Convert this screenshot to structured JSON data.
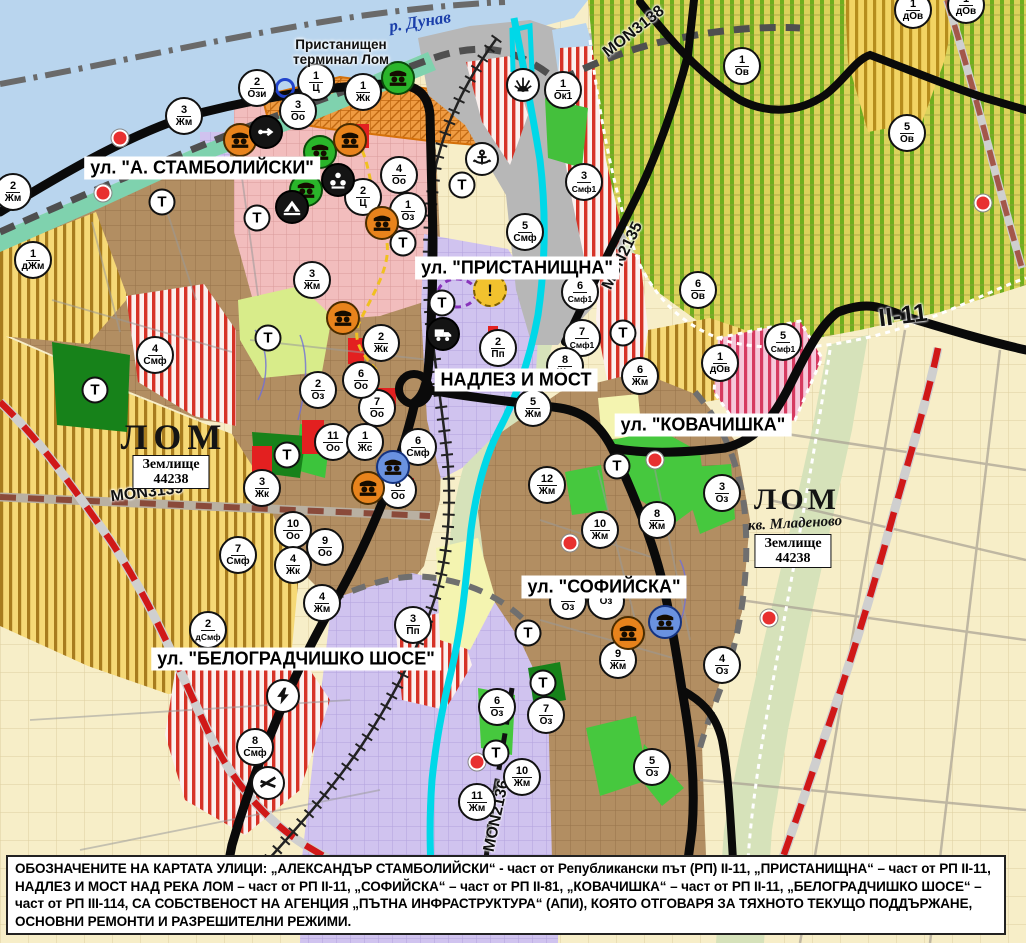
{
  "map": {
    "street_labels": [
      {
        "text": "ул. \"А. СТАМБОЛИЙСКИ\"",
        "x": 202,
        "y": 168
      },
      {
        "text": "ул. \"ПРИСТАНИЩНА\"",
        "x": 517,
        "y": 268
      },
      {
        "text": "НАДЛЕЗ И МОСТ",
        "x": 516,
        "y": 380
      },
      {
        "text": "ул. \"КОВАЧИШКА\"",
        "x": 703,
        "y": 425
      },
      {
        "text": "ул. \"СОФИЙСКА\"",
        "x": 604,
        "y": 587
      },
      {
        "text": "ул. \"БЕЛОГРАДЧИШКО ШОСЕ\"",
        "x": 296,
        "y": 659
      }
    ],
    "place_labels": [
      {
        "text": "р. Дунав",
        "x": 420,
        "y": 22,
        "rot": -9,
        "cls": "river",
        "name": "river-danube-label"
      },
      {
        "text": "Пристанищен\nтерминал Лом",
        "x": 341,
        "y": 52,
        "rot": 0,
        "cls": "terminal",
        "name": "port-terminal-label"
      },
      {
        "text": "ЛОМ",
        "x": 174,
        "y": 437,
        "rot": 0,
        "cls": "city",
        "name": "lom-city-label"
      },
      {
        "text": "Землище\n44238",
        "x": 171,
        "y": 472,
        "rot": 0,
        "cls": "zem",
        "name": "zemlishte-label"
      },
      {
        "text": "ЛОМ",
        "x": 797,
        "y": 500,
        "rot": 0,
        "cls": "city2",
        "name": "lom-mladenovo-label"
      },
      {
        "text": "кв. Младеново",
        "x": 795,
        "y": 524,
        "rot": -3,
        "cls": "kvartal",
        "name": "kvartal-label"
      },
      {
        "text": "Землище\n44238",
        "x": 793,
        "y": 551,
        "rot": 0,
        "cls": "zem",
        "name": "zemlishte-label-2"
      }
    ],
    "road_labels": [
      {
        "text": "MON3139",
        "x": 147,
        "y": 493,
        "rot": -7,
        "big": false
      },
      {
        "text": "MON3138",
        "x": 634,
        "y": 32,
        "rot": -38,
        "big": false
      },
      {
        "text": "MON2135",
        "x": 623,
        "y": 256,
        "rot": -64,
        "big": false
      },
      {
        "text": "MON2136",
        "x": 497,
        "y": 816,
        "rot": -78,
        "big": false
      },
      {
        "text": "II-11",
        "x": 903,
        "y": 316,
        "rot": -7,
        "big": true
      }
    ],
    "zone_markers": [
      {
        "x": 257,
        "y": 88,
        "num": "2",
        "code": "Ози"
      },
      {
        "x": 316,
        "y": 82,
        "num": "1",
        "code": "Ц"
      },
      {
        "x": 363,
        "y": 92,
        "num": "1",
        "code": "Жк"
      },
      {
        "x": 298,
        "y": 111,
        "num": "3",
        "code": "Оо"
      },
      {
        "x": 184,
        "y": 116,
        "num": "3",
        "code": "Жм"
      },
      {
        "x": 563,
        "y": 90,
        "num": "1",
        "code": "Ок1"
      },
      {
        "x": 13,
        "y": 192,
        "num": "2",
        "code": "Жм"
      },
      {
        "x": 33,
        "y": 260,
        "num": "1",
        "code": "дЖм"
      },
      {
        "x": 399,
        "y": 175,
        "num": "4",
        "code": "Оо"
      },
      {
        "x": 408,
        "y": 211,
        "num": "1",
        "code": "Оз"
      },
      {
        "x": 363,
        "y": 197,
        "num": "2",
        "code": "Ц"
      },
      {
        "x": 584,
        "y": 182,
        "num": "3",
        "code": "Смф1"
      },
      {
        "x": 525,
        "y": 232,
        "num": "5",
        "code": "Смф"
      },
      {
        "x": 312,
        "y": 280,
        "num": "3",
        "code": "Жм"
      },
      {
        "x": 742,
        "y": 66,
        "num": "1",
        "code": "Ов"
      },
      {
        "x": 907,
        "y": 133,
        "num": "5",
        "code": "Ов"
      },
      {
        "x": 913,
        "y": 10,
        "num": "1",
        "code": "дОв"
      },
      {
        "x": 966,
        "y": 5,
        "num": "1",
        "code": "дОв"
      },
      {
        "x": 580,
        "y": 292,
        "num": "6",
        "code": "Смф1"
      },
      {
        "x": 582,
        "y": 338,
        "num": "7",
        "code": "Смф1"
      },
      {
        "x": 498,
        "y": 348,
        "num": "2",
        "code": "Пп"
      },
      {
        "x": 565,
        "y": 366,
        "num": "8",
        "code": "Жм"
      },
      {
        "x": 533,
        "y": 408,
        "num": "5",
        "code": "Жм"
      },
      {
        "x": 640,
        "y": 376,
        "num": "6",
        "code": "Жм"
      },
      {
        "x": 698,
        "y": 290,
        "num": "6",
        "code": "Ов"
      },
      {
        "x": 783,
        "y": 342,
        "num": "5",
        "code": "Смф1"
      },
      {
        "x": 720,
        "y": 363,
        "num": "1",
        "code": "дОв"
      },
      {
        "x": 377,
        "y": 408,
        "num": "7",
        "code": "Оо"
      },
      {
        "x": 361,
        "y": 380,
        "num": "6",
        "code": "Оо"
      },
      {
        "x": 381,
        "y": 343,
        "num": "2",
        "code": "Жк"
      },
      {
        "x": 318,
        "y": 390,
        "num": "2",
        "code": "Оз"
      },
      {
        "x": 333,
        "y": 442,
        "num": "11",
        "code": "Оо"
      },
      {
        "x": 365,
        "y": 442,
        "num": "1",
        "code": "Жс"
      },
      {
        "x": 418,
        "y": 447,
        "num": "6",
        "code": "Смф"
      },
      {
        "x": 398,
        "y": 490,
        "num": "8",
        "code": "Оо"
      },
      {
        "x": 262,
        "y": 488,
        "num": "3",
        "code": "Жк"
      },
      {
        "x": 293,
        "y": 530,
        "num": "10",
        "code": "Оо"
      },
      {
        "x": 325,
        "y": 547,
        "num": "9",
        "code": "Оо"
      },
      {
        "x": 293,
        "y": 565,
        "num": "4",
        "code": "Жк"
      },
      {
        "x": 238,
        "y": 555,
        "num": "7",
        "code": "Смф"
      },
      {
        "x": 155,
        "y": 355,
        "num": "4",
        "code": "Смф"
      },
      {
        "x": 322,
        "y": 603,
        "num": "4",
        "code": "Жм"
      },
      {
        "x": 208,
        "y": 630,
        "num": "2",
        "code": "дСмф"
      },
      {
        "x": 413,
        "y": 625,
        "num": "3",
        "code": "Пп"
      },
      {
        "x": 255,
        "y": 747,
        "num": "8",
        "code": "Смф"
      },
      {
        "x": 547,
        "y": 485,
        "num": "12",
        "code": "Жм"
      },
      {
        "x": 600,
        "y": 530,
        "num": "10",
        "code": "Жм"
      },
      {
        "x": 657,
        "y": 520,
        "num": "8",
        "code": "Жм"
      },
      {
        "x": 722,
        "y": 493,
        "num": "3",
        "code": "Оз"
      },
      {
        "x": 568,
        "y": 601,
        "num": "9",
        "code": "Оз"
      },
      {
        "x": 606,
        "y": 601,
        "num": "",
        "code": "Оз"
      },
      {
        "x": 618,
        "y": 660,
        "num": "9",
        "code": "Жм"
      },
      {
        "x": 722,
        "y": 665,
        "num": "4",
        "code": "Оз"
      },
      {
        "x": 497,
        "y": 707,
        "num": "6",
        "code": "Оз"
      },
      {
        "x": 546,
        "y": 715,
        "num": "7",
        "code": "Оз"
      },
      {
        "x": 522,
        "y": 777,
        "num": "10",
        "code": "Жм"
      },
      {
        "x": 477,
        "y": 802,
        "num": "11",
        "code": "Жм"
      },
      {
        "x": 652,
        "y": 767,
        "num": "5",
        "code": "Оз"
      }
    ],
    "t_symbol": "Т",
    "t_markers": [
      {
        "x": 95,
        "y": 390
      },
      {
        "x": 162,
        "y": 202
      },
      {
        "x": 257,
        "y": 218
      },
      {
        "x": 268,
        "y": 338
      },
      {
        "x": 287,
        "y": 455
      },
      {
        "x": 403,
        "y": 243
      },
      {
        "x": 442,
        "y": 303
      },
      {
        "x": 462,
        "y": 185
      },
      {
        "x": 617,
        "y": 466
      },
      {
        "x": 528,
        "y": 633
      },
      {
        "x": 543,
        "y": 683
      },
      {
        "x": 496,
        "y": 753
      },
      {
        "x": 623,
        "y": 333
      }
    ],
    "icons": [
      {
        "x": 398,
        "y": 78,
        "type": "monument",
        "color": "green"
      },
      {
        "x": 320,
        "y": 152,
        "type": "monument",
        "color": "green"
      },
      {
        "x": 306,
        "y": 190,
        "type": "monument",
        "color": "green"
      },
      {
        "x": 240,
        "y": 140,
        "type": "monument",
        "color": "orange"
      },
      {
        "x": 350,
        "y": 140,
        "type": "monument",
        "color": "orange"
      },
      {
        "x": 382,
        "y": 223,
        "type": "monument",
        "color": "orange"
      },
      {
        "x": 343,
        "y": 318,
        "type": "monument",
        "color": "orange"
      },
      {
        "x": 368,
        "y": 488,
        "type": "monument",
        "color": "orange"
      },
      {
        "x": 628,
        "y": 633,
        "type": "monument",
        "color": "orange"
      },
      {
        "x": 393,
        "y": 467,
        "type": "monument",
        "color": "blue"
      },
      {
        "x": 665,
        "y": 622,
        "type": "monument",
        "color": "blue"
      },
      {
        "x": 266,
        "y": 132,
        "type": "arrow",
        "color": "black"
      },
      {
        "x": 338,
        "y": 180,
        "type": "people",
        "color": "black"
      },
      {
        "x": 292,
        "y": 207,
        "type": "cave",
        "color": "black"
      },
      {
        "x": 443,
        "y": 334,
        "type": "truck",
        "color": "black"
      },
      {
        "x": 482,
        "y": 159,
        "type": "anchor",
        "color": "white"
      },
      {
        "x": 523,
        "y": 85,
        "type": "fan",
        "color": "white"
      },
      {
        "x": 490,
        "y": 290,
        "type": "warning",
        "color": "yellow"
      },
      {
        "x": 283,
        "y": 696,
        "type": "lightning",
        "color": "white"
      },
      {
        "x": 268,
        "y": 783,
        "type": "barrier",
        "color": "white"
      },
      {
        "x": 285,
        "y": 88,
        "type": "ring",
        "color": "blue"
      }
    ],
    "red_dots": [
      {
        "x": 120,
        "y": 138
      },
      {
        "x": 103,
        "y": 193
      },
      {
        "x": 570,
        "y": 543
      },
      {
        "x": 655,
        "y": 460
      },
      {
        "x": 477,
        "y": 762
      },
      {
        "x": 769,
        "y": 618
      },
      {
        "x": 983,
        "y": 203
      }
    ]
  },
  "caption": {
    "segments": [
      {
        "t": "ОБОЗНАЧЕНИТЕ НА КАРТАТА УЛИЦИ: „АЛЕКСАНДЪР СТАМБОЛИЙСКИ“",
        "b": true
      },
      {
        "t": " - част от Републикански път (РП) II-11, ",
        "b": false
      },
      {
        "t": "„ПРИСТАНИЩНА“",
        "b": true
      },
      {
        "t": " – част от РП II-11, ",
        "b": false
      },
      {
        "t": "НАДЛЕЗ И МОСТ НАД РЕКА ЛОМ",
        "b": true
      },
      {
        "t": " – част от РП II-11, ",
        "b": false
      },
      {
        "t": "„СОФИЙСКА“",
        "b": true
      },
      {
        "t": " – част от РП II-81, ",
        "b": false
      },
      {
        "t": "„КОВАЧИШКА“",
        "b": true
      },
      {
        "t": " – част от РП II-11, ",
        "b": false
      },
      {
        "t": "„БЕЛОГРАДЧИШКО ШОСЕ“",
        "b": true
      },
      {
        "t": " – част от РП III-114, ",
        "b": false
      },
      {
        "t": "СА СОБСТВЕНОСТ НА АГЕНЦИЯ „ПЪТНА ИНФРАСТРУКТУРА“ (АПИ), КОЯТО ОТГОВАРЯ ЗА ТЯХНОТО ТЕКУЩО ПОДДЪРЖАНЕ, ОСНОВНИ РЕМОНТИ И РАЗРЕШИТЕЛНИ РЕЖИМИ.",
        "b": true
      }
    ]
  },
  "colors": {
    "water": "#b9d5ee",
    "coast": "#7fd2ae",
    "urban_brown": "#b28e62",
    "stripes_yellow": "#f6d976",
    "stripes_olive": "#dcd35c",
    "lavender": "#d0c3ef",
    "pink": "#f2bdbd",
    "port_grey": "#b7b7b7",
    "park_green": "#3cc43c",
    "terrain_green": "#17821a",
    "red_zone": "#e32020",
    "river_lom": "#00d8e8"
  }
}
